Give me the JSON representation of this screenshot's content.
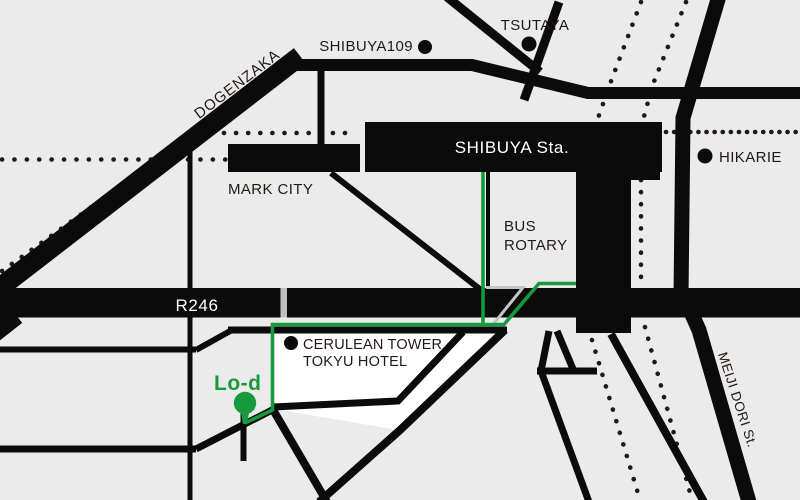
{
  "map": {
    "labels": {
      "shibuya109": "SHIBUYA109",
      "tsutaya": "TSUTAYA",
      "shibuya_station": "SHIBUYA Sta.",
      "hikarie": "HIKARIE",
      "mark_city": "MARK CITY",
      "bus_rotary_line1": "BUS",
      "bus_rotary_line2": "ROTARY",
      "route246": "R246",
      "dogenzaka": "DOGENZAKA",
      "cerulean_line1": "CERULEAN TOWER",
      "cerulean_line2": "TOKYU HOTEL",
      "meiji_dori": "MEIJI DORI St.",
      "destination": "Lo-d"
    },
    "colors": {
      "background": "#ebebeb",
      "road": "#0b0b0b",
      "route_green": "#17993e",
      "railway_dotted": "#231815",
      "highlight_box": "#ffffff",
      "crossing_gray": "#c4c4c4",
      "band_gap_gray": "#c0c0c0",
      "label_text": "#231815",
      "station_text": "#ffffff"
    }
  }
}
